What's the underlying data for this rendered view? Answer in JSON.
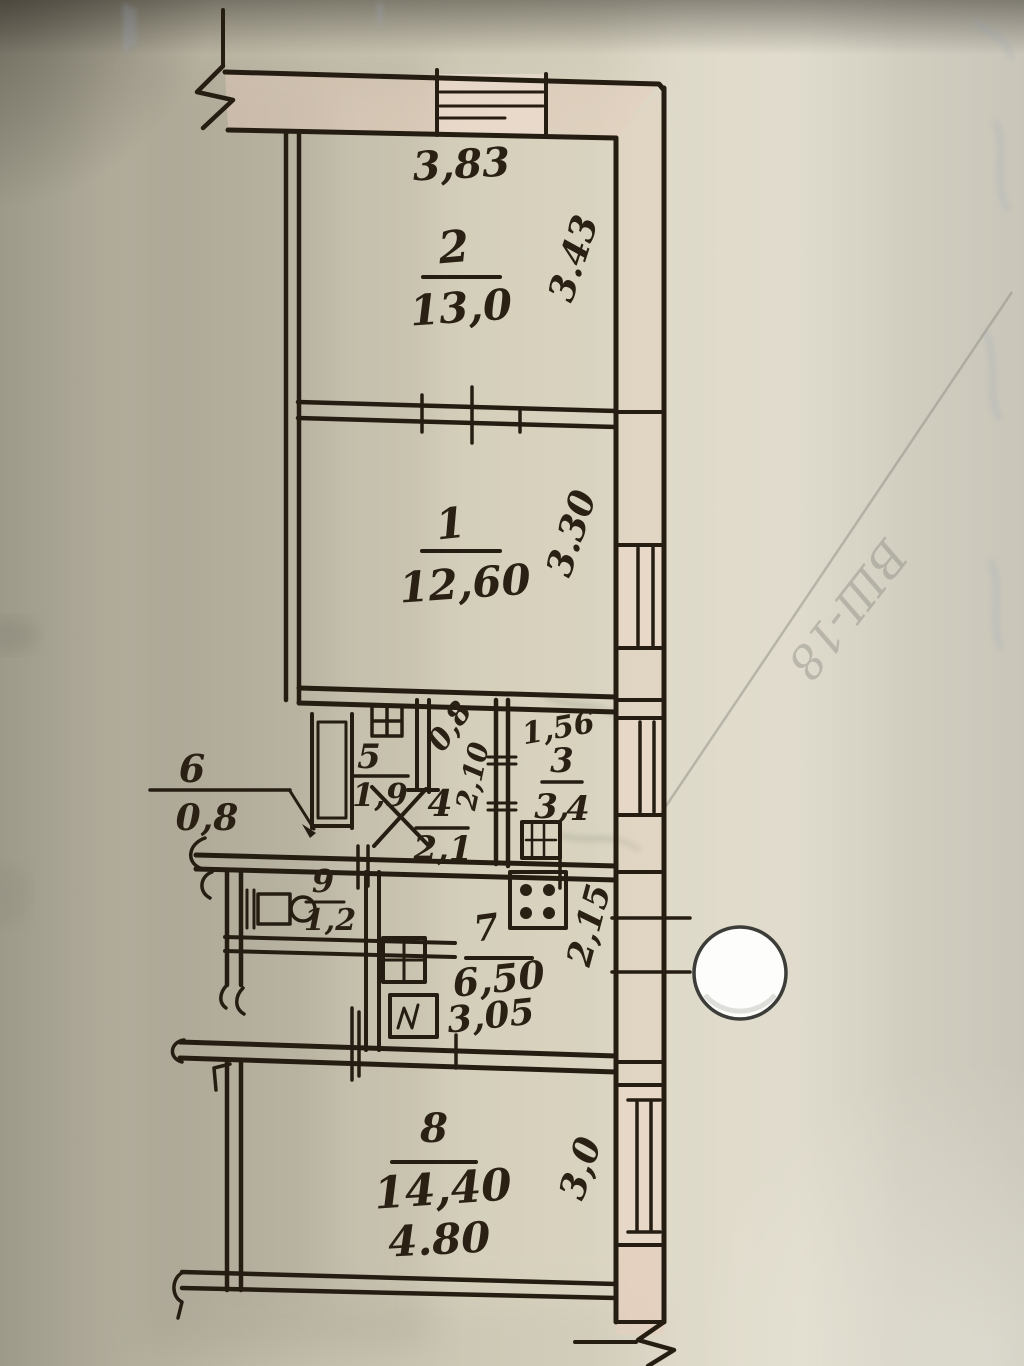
{
  "photo": {
    "description": "hand-drawn apartment floor plan sketch on aged paper"
  },
  "dims": {
    "top_width": "3,83",
    "room2": {
      "num": "2",
      "area": "13,0",
      "depth": "3.43"
    },
    "room1": {
      "num": "1",
      "area": "12,60",
      "depth": "3.30"
    },
    "room3": {
      "num": "3",
      "width": "1,56",
      "area_left": "3,",
      "area_right": "4"
    },
    "room4": {
      "num": "4",
      "area": "2,1",
      "width": "0,8",
      "depth": "2,10"
    },
    "room5": {
      "num": "5",
      "area": "1,9"
    },
    "room6": {
      "num": "6",
      "area": "0,8"
    },
    "room7": {
      "num": "7",
      "area": "6,50",
      "width": "3,05",
      "depth": "2,15"
    },
    "room8": {
      "num": "8",
      "area": "14,40",
      "width": "4.80",
      "depth": "3,0"
    },
    "room9": {
      "num": "9",
      "area": "1,2"
    }
  },
  "colors": {
    "ink": "#261d12",
    "wall_pink": "#e7cdbd",
    "correction_red": "#7a2a22",
    "paper": "#d0cbb8"
  },
  "pencil_note": "ВШ-18"
}
